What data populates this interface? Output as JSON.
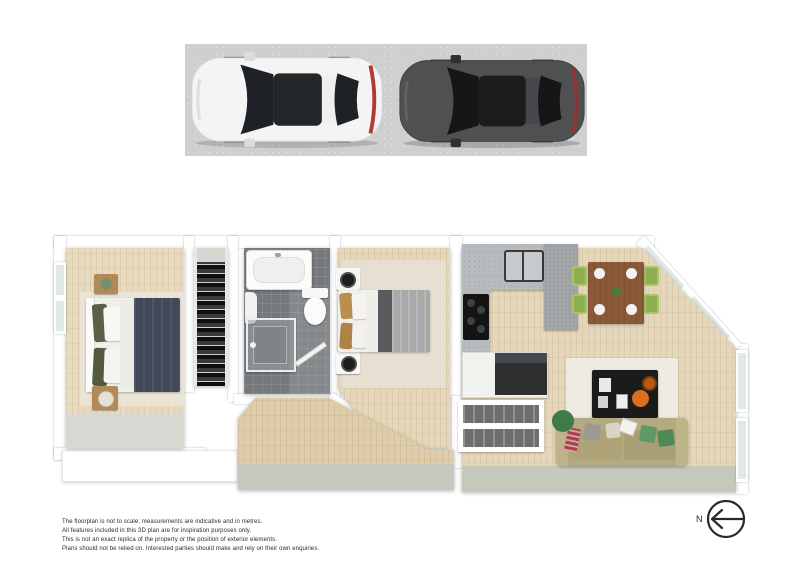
{
  "meta": {
    "type": "3d-floorplan-render",
    "canvas_width": 800,
    "canvas_height": 565
  },
  "parking": {
    "surface": "concrete-pad",
    "surface_color": "#cfcfcf",
    "cars": [
      {
        "name": "white-car",
        "body_color": "#f4f4f4",
        "glass_color": "#1e2226",
        "facing": "left"
      },
      {
        "name": "dark-car",
        "body_color": "#4e5052",
        "glass_color": "#141618",
        "facing": "left"
      }
    ]
  },
  "floorplan": {
    "wall_color": "#ffffff",
    "wood_floor_color": "#e2d3b2",
    "tile_floor_color": "#75797b",
    "entry_floor_color": "#c7c8bd",
    "rooms": [
      {
        "name": "bedroom-1"
      },
      {
        "name": "wardrobe"
      },
      {
        "name": "bathroom"
      },
      {
        "name": "bedroom-2"
      },
      {
        "name": "hallway"
      },
      {
        "name": "kitchen"
      },
      {
        "name": "dining-area"
      },
      {
        "name": "living-area"
      },
      {
        "name": "stairs"
      }
    ],
    "furniture_colors": {
      "bed1_duvet": "#414857",
      "bed2_duvet": "#a8a8a8",
      "sofa": "#b4aa80",
      "dining_table": "#8a5a38",
      "dining_chairs": "#8fae52",
      "coffee_table": "#1b1b1b",
      "accent_orange": "#d96f1f",
      "nightstand_wood": "#b28a58"
    }
  },
  "disclaimer": {
    "lines": [
      "The floorplan is not to scale; measurements are indicative and in metres.",
      "All features included in this 3D plan are for inspiration purposes only.",
      "This is not an exact replica of the property or the position of exterior elements.",
      "Plans should not be relied on. Interested parties should make and rely on their own enquiries."
    ]
  },
  "compass": {
    "label": "N",
    "direction": "left"
  }
}
